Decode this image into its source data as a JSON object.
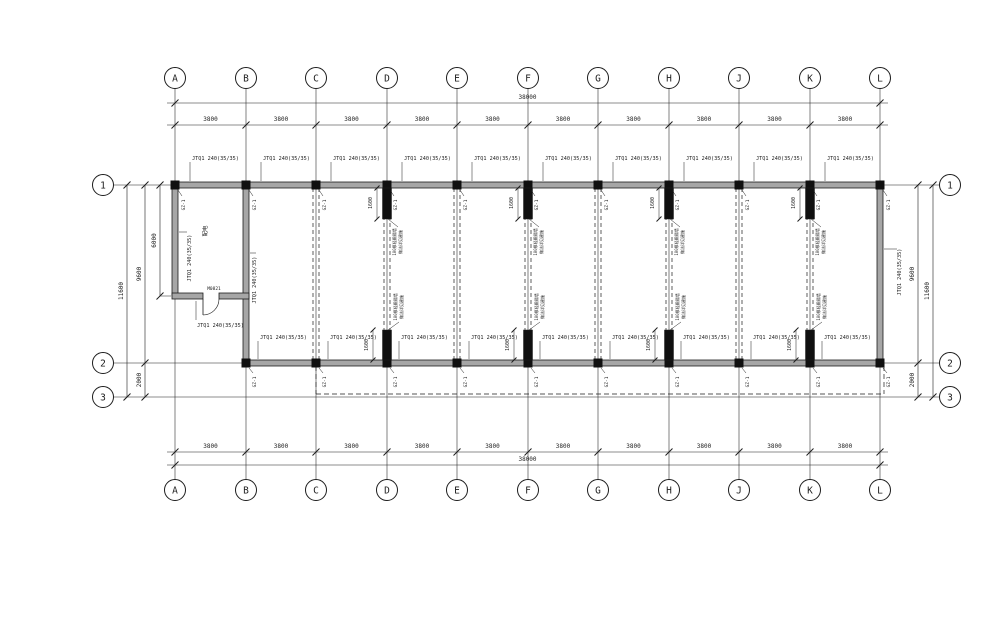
{
  "sheet": {
    "bg": "#ffffff",
    "ink": "#1c1c1c",
    "wall_fill": "#a6a6a6",
    "pier_fill": "#101010"
  },
  "grid": {
    "cols": [
      {
        "id": "A",
        "x": 175
      },
      {
        "id": "B",
        "x": 246
      },
      {
        "id": "C",
        "x": 316
      },
      {
        "id": "D",
        "x": 387
      },
      {
        "id": "E",
        "x": 457
      },
      {
        "id": "F",
        "x": 528
      },
      {
        "id": "G",
        "x": 598
      },
      {
        "id": "H",
        "x": 669
      },
      {
        "id": "J",
        "x": 739
      },
      {
        "id": "K",
        "x": 810
      },
      {
        "id": "L",
        "x": 880
      }
    ],
    "rows": [
      {
        "id": "1",
        "y": 185
      },
      {
        "id": "2",
        "y": 363
      },
      {
        "id": "3",
        "y": 397
      }
    ]
  },
  "dims": {
    "total": "38000",
    "bay": "3800",
    "left_total": "11600",
    "row1_row2": "9600",
    "row2_row3": "2000",
    "room_depth": "6000",
    "pier_length": "1600"
  },
  "labels": {
    "wall_type": "JTQ1 240(35/35)",
    "column_tag": "GZ-1",
    "door_tag": "M0821",
    "room_name": "配电",
    "note_line1": "100厚轻质隔墙",
    "note_line2": "做法详见建施"
  },
  "piers_at": [
    "D",
    "F",
    "H",
    "K"
  ],
  "partitions_at": [
    "C",
    "D",
    "E",
    "F",
    "G",
    "H",
    "J",
    "K"
  ],
  "row2_wall_from": "B",
  "canopy": {
    "from_col": "C",
    "to_col": "L"
  }
}
